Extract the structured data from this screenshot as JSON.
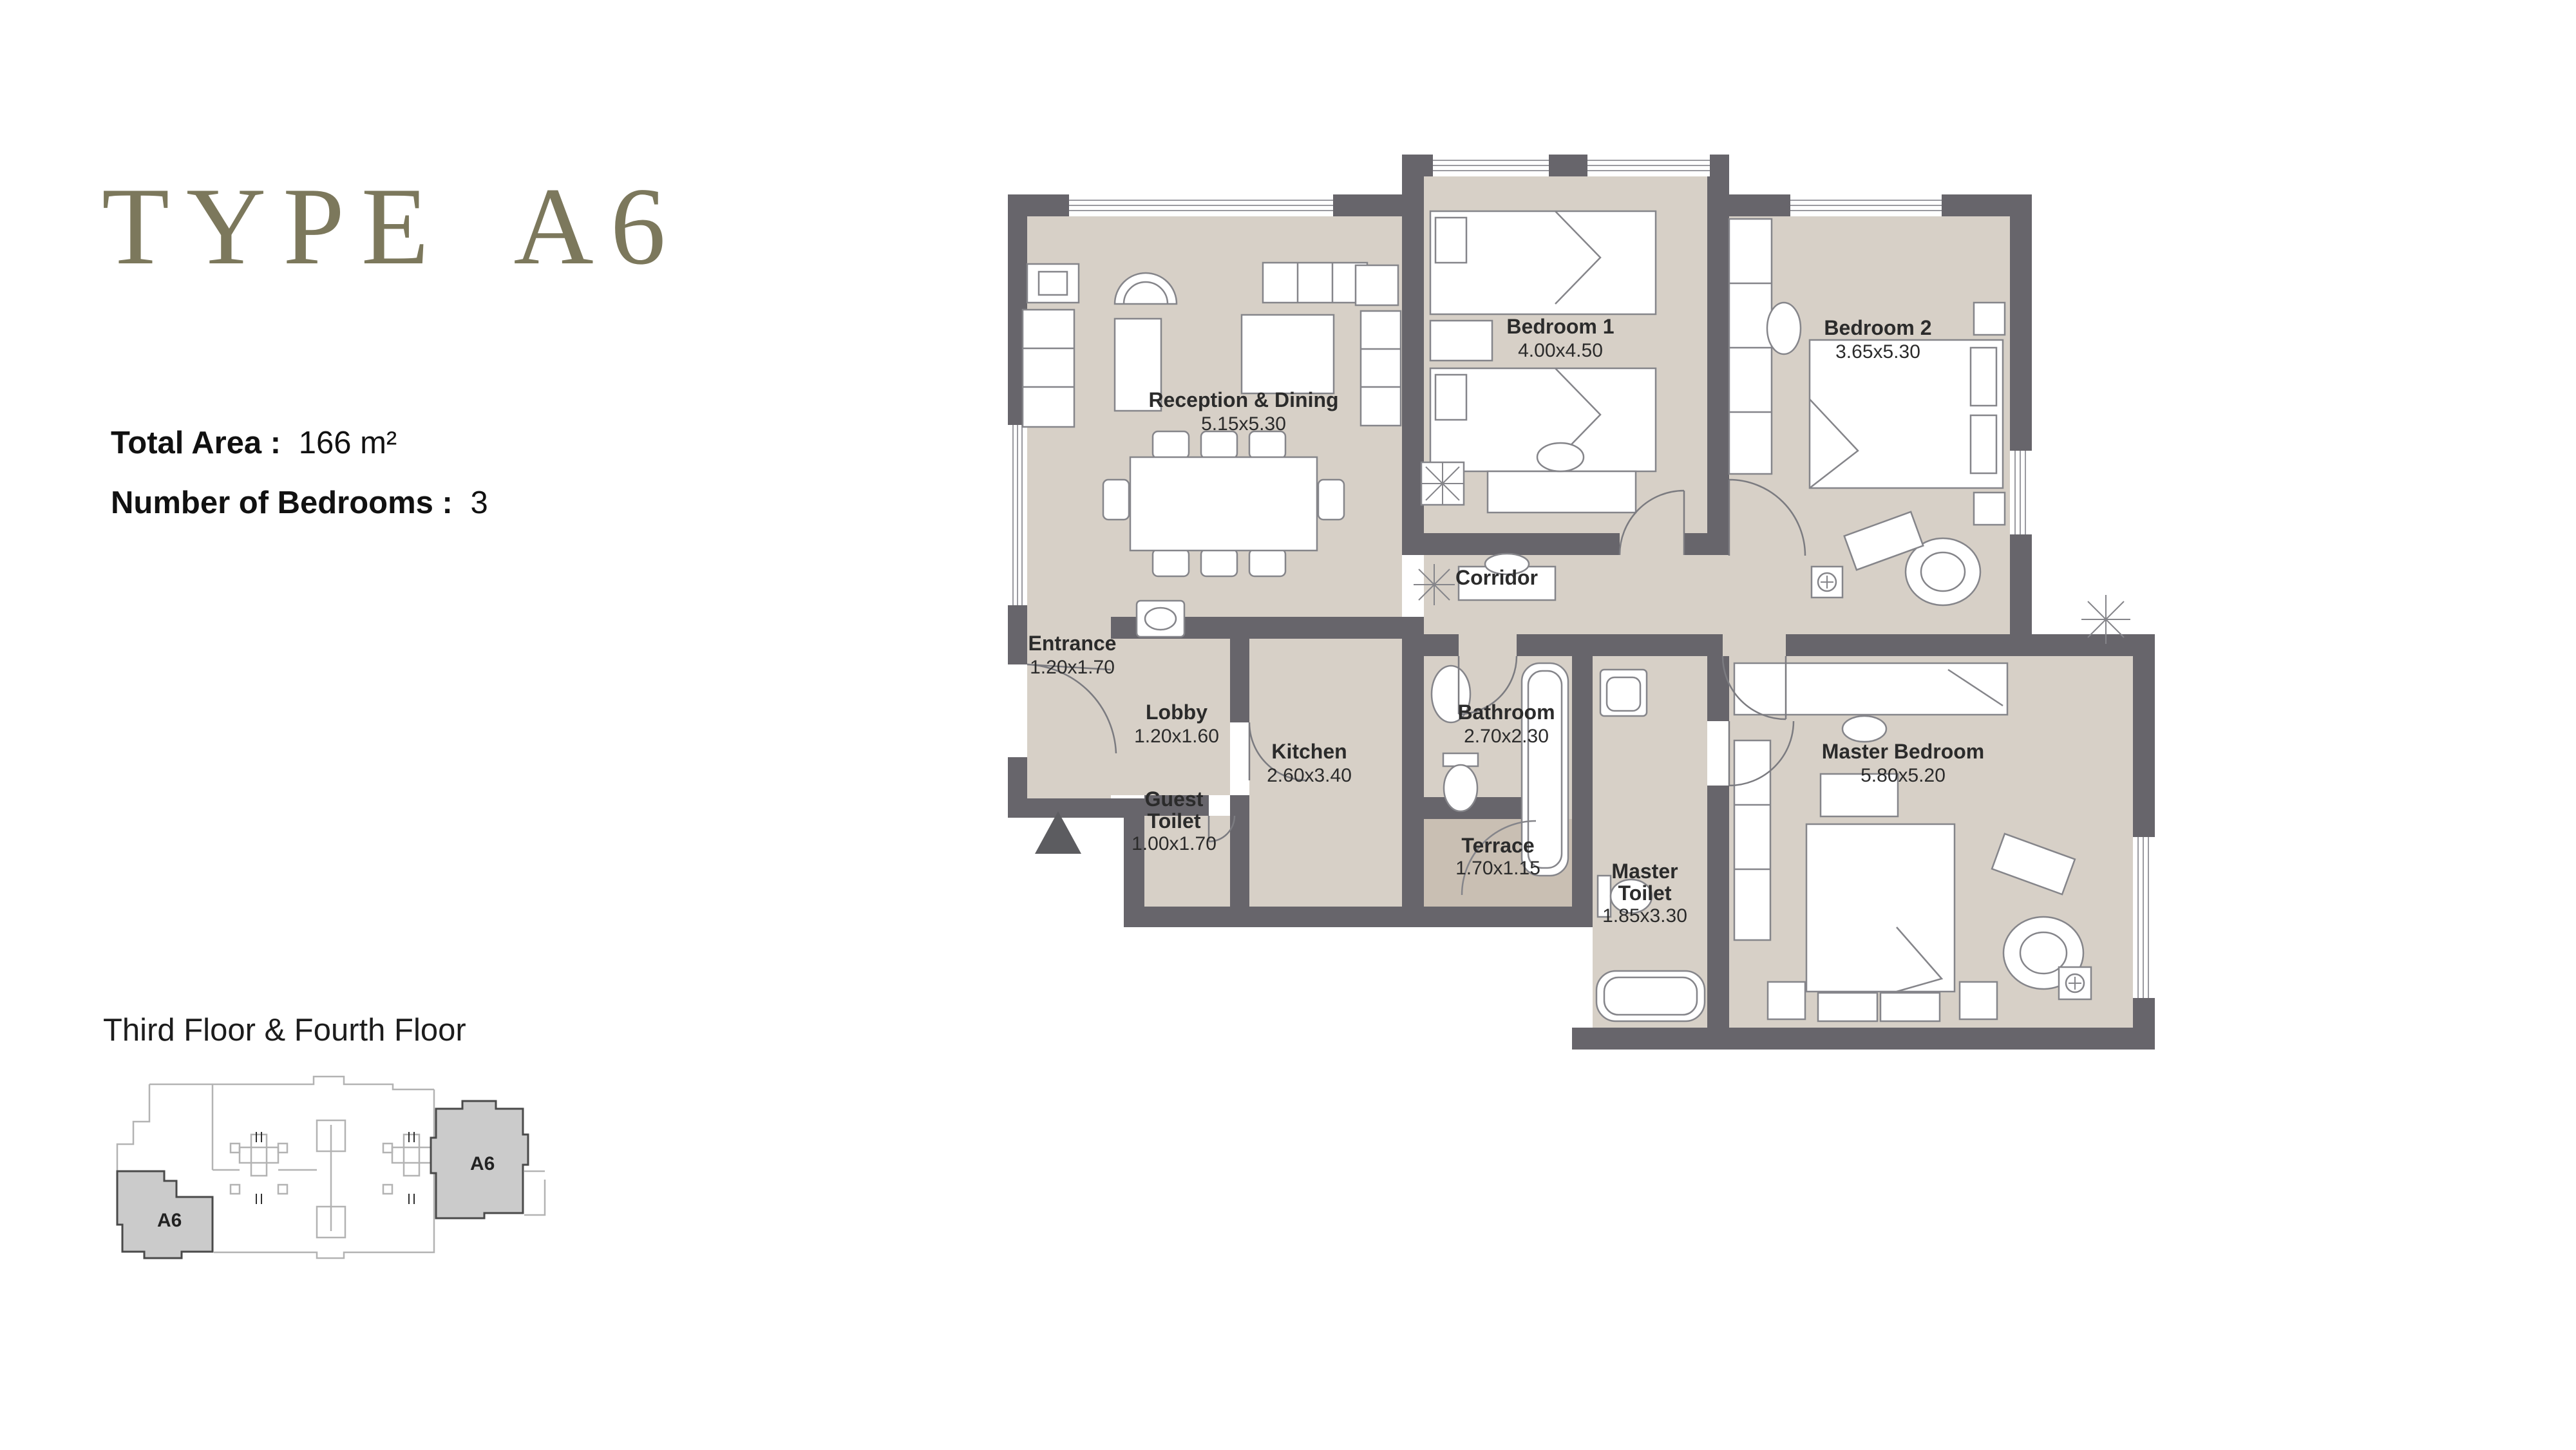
{
  "page": {
    "background": "#ffffff"
  },
  "header": {
    "title": "TYPE A6",
    "title_color": "#7c785c"
  },
  "specs": {
    "total_area_label": "Total Area :",
    "total_area_value": "166 m²",
    "bedrooms_label": "Number of Bedrooms :",
    "bedrooms_value": "3"
  },
  "floor_note": "Third Floor & Fourth Floor",
  "key_plan": {
    "units": [
      {
        "label": "A6"
      },
      {
        "label": "A6"
      }
    ],
    "highlight_fill": "#cbcbcb",
    "outline_color": "#b3b3b3"
  },
  "floor_plan": {
    "colors": {
      "room_fill": "#d7d0c7",
      "terrace_fill": "#c9bfb3",
      "wall": "#67656b",
      "furniture_line": "#85858a",
      "label_text": "#2b2b2b"
    },
    "rooms": [
      {
        "id": "reception",
        "name": "Reception & Dining",
        "dims": "5.15x5.30"
      },
      {
        "id": "bedroom1",
        "name": "Bedroom 1",
        "dims": "4.00x4.50"
      },
      {
        "id": "bedroom2",
        "name": "Bedroom 2",
        "dims": "3.65x5.30"
      },
      {
        "id": "corridor",
        "name": "Corridor",
        "dims": ""
      },
      {
        "id": "entrance",
        "name": "Entrance",
        "dims": "1.20x1.70"
      },
      {
        "id": "lobby",
        "name": "Lobby",
        "dims": "1.20x1.60"
      },
      {
        "id": "kitchen",
        "name": "Kitchen",
        "dims": "2.60x3.40"
      },
      {
        "id": "guest-toilet",
        "name": "Guest Toilet",
        "line1": "Guest",
        "line2": "Toilet",
        "dims": "1.00x1.70"
      },
      {
        "id": "bathroom",
        "name": "Bathroom",
        "dims": "2.70x2.30"
      },
      {
        "id": "terrace",
        "name": "Terrace",
        "dims": "1.70x1.15"
      },
      {
        "id": "master-toilet",
        "name": "Master Toilet",
        "line1": "Master",
        "line2": "Toilet",
        "dims": "1.85x3.30"
      },
      {
        "id": "master-bedroom",
        "name": "Master Bedroom",
        "dims": "5.80x5.20"
      }
    ]
  }
}
